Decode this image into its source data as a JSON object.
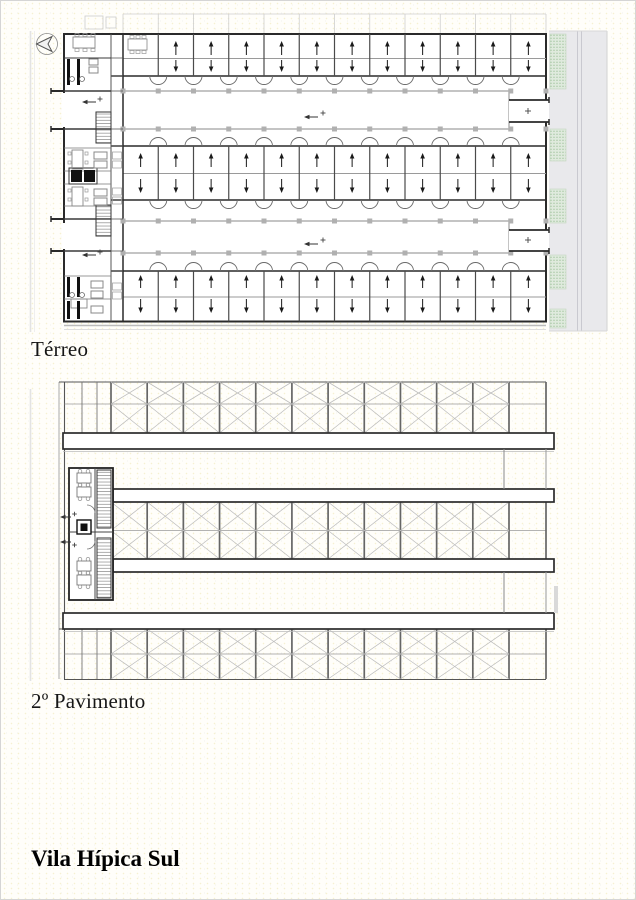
{
  "labels": {
    "plan1": "Térreo",
    "plan2": "2º Pavimento",
    "title": "Vila Hípica Sul"
  },
  "terreo": {
    "stall_columns": 12,
    "stall_bands": 3,
    "corridor_count": 2,
    "planting_beds": [
      [
        33,
        88
      ],
      [
        128,
        160
      ],
      [
        188,
        222
      ],
      [
        254,
        288
      ],
      [
        308,
        327
      ]
    ]
  },
  "pavimento2": {
    "braced_bays": 11,
    "rows_per_band": 2,
    "band_count": 3,
    "beam_count": 4
  },
  "colors": {
    "line_dark": "#2a2a2a",
    "line_mid": "#666666",
    "line_gray": "#9a9a9a",
    "line_light": "#bdbdbd",
    "column_gray": "#b0b0b0",
    "road_fill": "#e9e9ec",
    "road_line": "#c9c9d0",
    "green_fill": "#dfeadd",
    "green_dot": "#9fc29b",
    "beam_stroke": "#2b2b2b",
    "shadow": "#bbbbbb",
    "margin_line": "#e3e3e3",
    "arrow": "#1a1a1a",
    "text": "#141414"
  }
}
